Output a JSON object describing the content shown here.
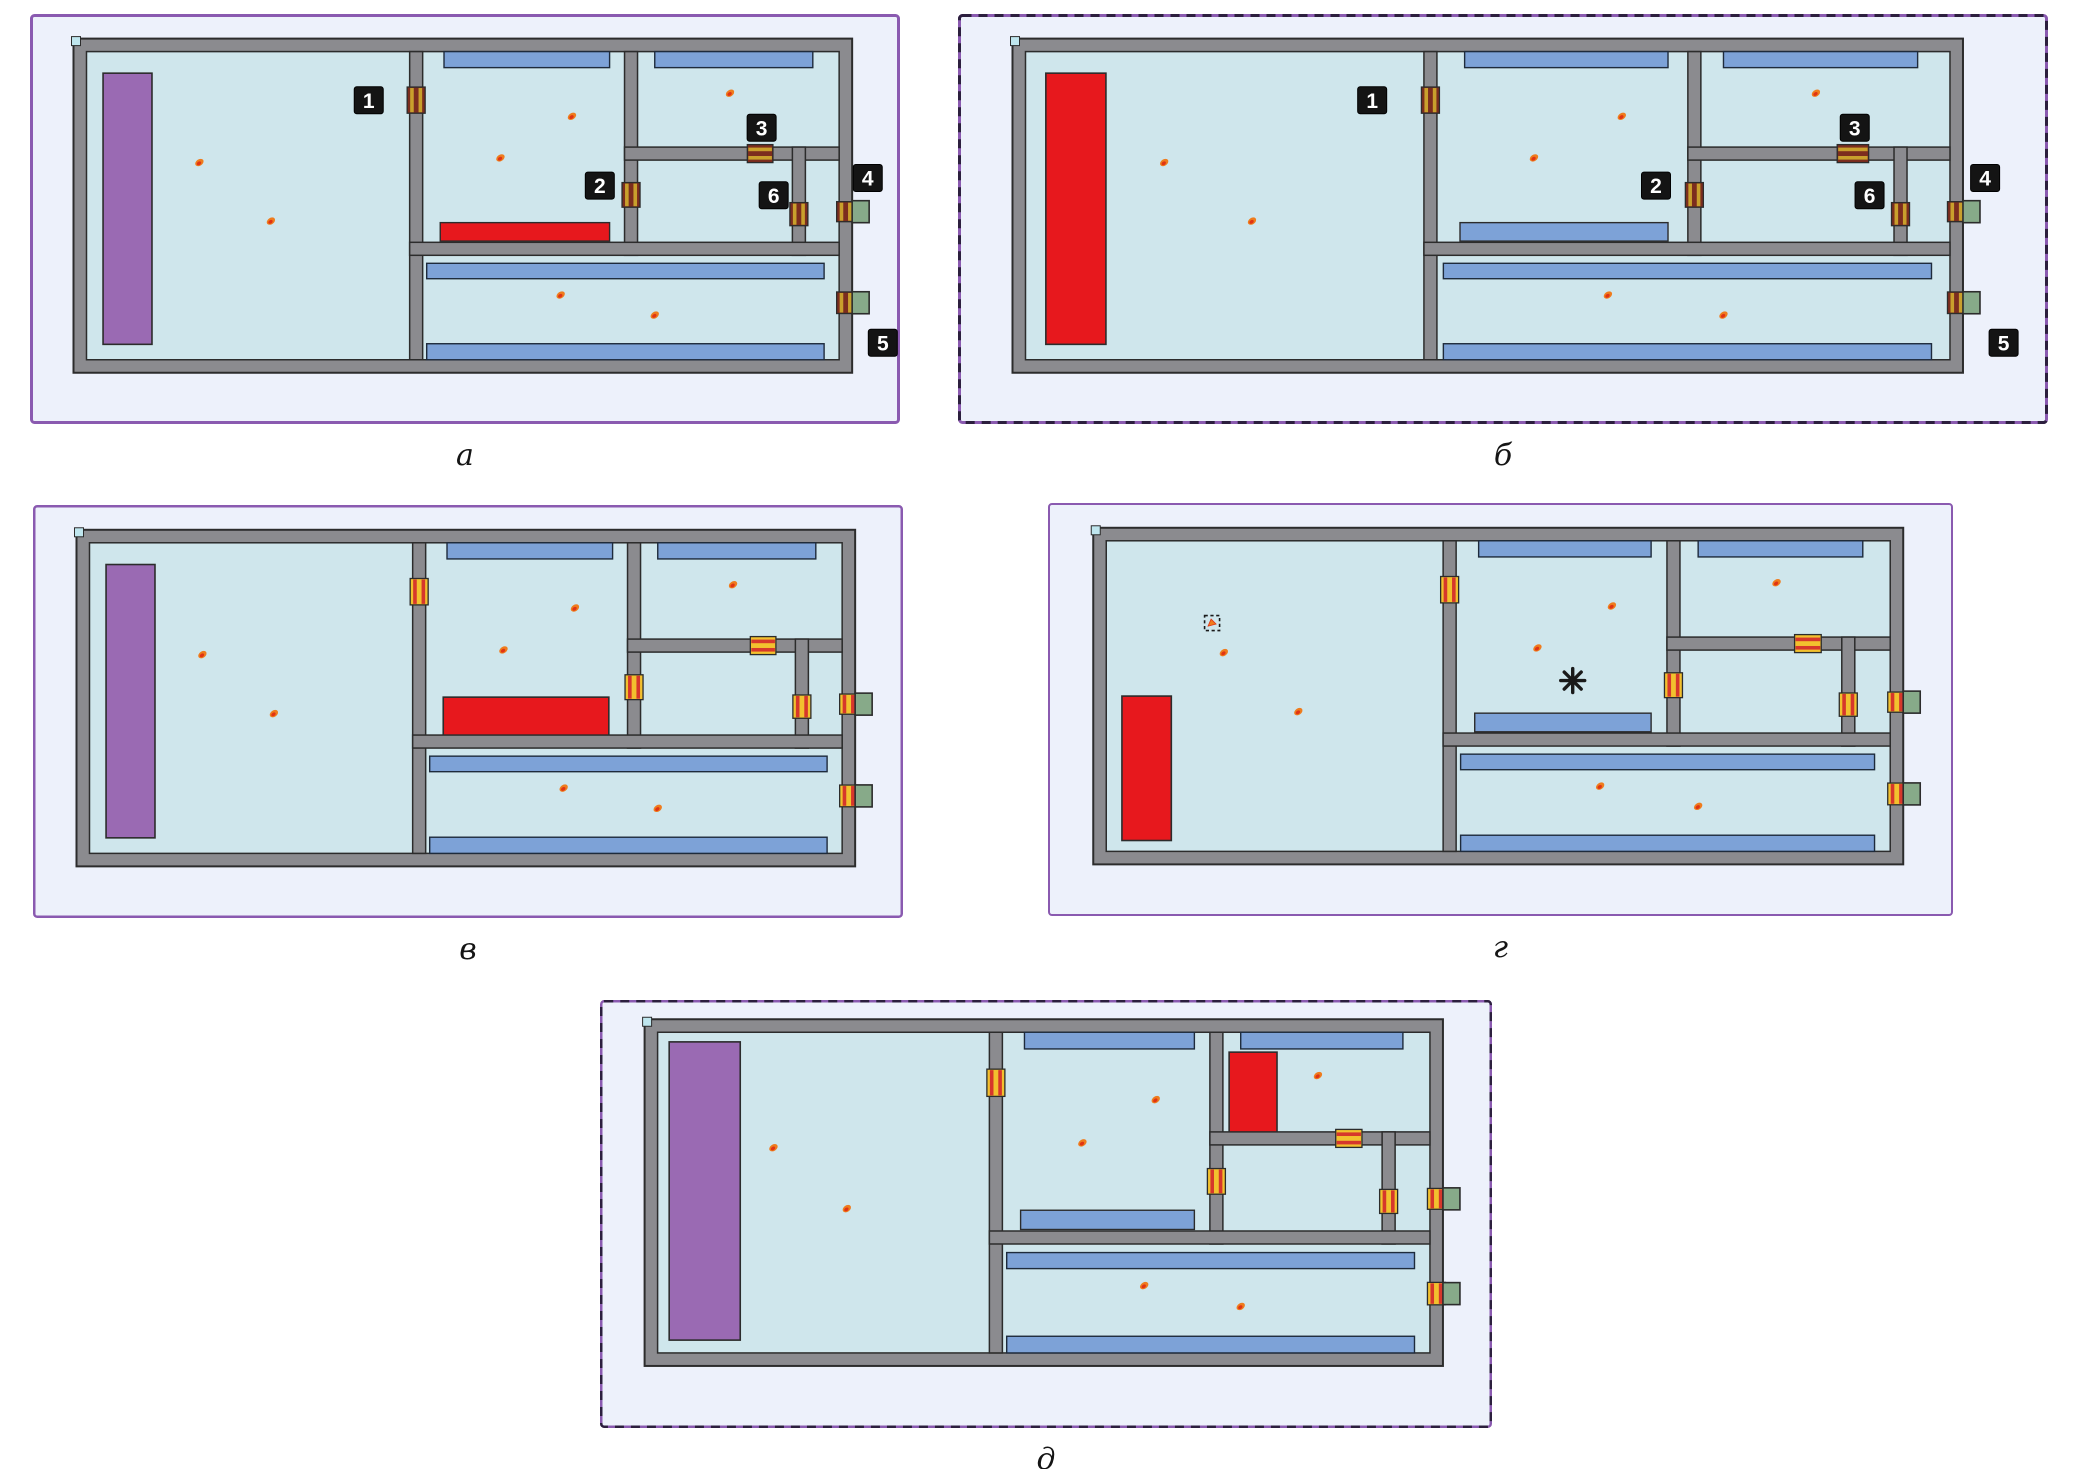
{
  "figure": {
    "colors": {
      "page_bg": "#ffffff",
      "panel_bg": "#edf1fb",
      "room": "#cfe6ec",
      "wall_fill": "#8b8b8f",
      "wall_stroke": "#2c2c2c",
      "window_blue": "#7da2d7",
      "window_stroke": "#1e2b3c",
      "stage_purple": "#9a6ab3",
      "fire_red": "#e7181d",
      "exit_green": "#87aa89",
      "door_gold_bg": "#7c2d1e",
      "door_gold_stripe": "#c9a02c",
      "door_flame_bg": "#f2c12e",
      "door_flame_stripe": "#d6372b",
      "border_purple": "#8a5ab0",
      "border_dash": "#2c1f3e",
      "callout_bg": "#141414",
      "callout_fg": "#ffffff",
      "occupant_outer": "#ef7c1d",
      "occupant_inner": "#e03414",
      "marker_dark": "#1a1a1a",
      "corner_marker": "#bfe6ee"
    },
    "plan_layout": {
      "outer": {
        "left": 0.05,
        "top": 0.06,
        "right": 0.945,
        "bottom": 0.875
      },
      "wall_px": 13,
      "walls": {
        "v1": 0.438,
        "v2": 0.7235,
        "v3": 0.9465,
        "h1": 0.331,
        "h2": 0.64
      },
      "doors": [
        {
          "id": "door-1",
          "wall": "v1",
          "from": 0.115,
          "to": 0.2
        },
        {
          "id": "door-2",
          "wall": "v2",
          "from": 0.425,
          "to": 0.505
        },
        {
          "id": "door-3",
          "wall": "h1",
          "from": 0.878,
          "to": 0.912
        },
        {
          "id": "door-6",
          "wall": "v3",
          "from": 0.49,
          "to": 0.565
        },
        {
          "id": "door-4",
          "wall": "right",
          "from": 0.487,
          "to": 0.552,
          "exit": true
        },
        {
          "id": "door-5",
          "wall": "right",
          "from": 0.78,
          "to": 0.85,
          "exit": true
        }
      ],
      "windows": [
        {
          "id": "room2-top-window",
          "x": 0.475,
          "y": 0.0,
          "w": 0.22,
          "h": 0.052
        },
        {
          "id": "room3-top-window",
          "x": 0.755,
          "y": 0.0,
          "w": 0.21,
          "h": 0.052
        },
        {
          "id": "corridor-top-window",
          "x": 0.452,
          "y": 0.687,
          "w": 0.528,
          "h": 0.05
        },
        {
          "id": "corridor-bottom-window",
          "x": 0.452,
          "y": 0.948,
          "w": 0.528,
          "h": 0.052
        }
      ],
      "room2_strip": {
        "x": 0.47,
        "y": 0.555,
        "w": 0.225,
        "h": 0.06
      },
      "stage": {
        "x": 0.022,
        "y": 0.07,
        "w": 0.065,
        "h": 0.88
      },
      "occupants": [
        {
          "x": 0.15,
          "y": 0.36
        },
        {
          "x": 0.245,
          "y": 0.55
        },
        {
          "x": 0.645,
          "y": 0.21
        },
        {
          "x": 0.55,
          "y": 0.345
        },
        {
          "x": 0.855,
          "y": 0.135
        },
        {
          "x": 0.63,
          "y": 0.79
        },
        {
          "x": 0.755,
          "y": 0.855
        }
      ],
      "callouts": [
        {
          "label": "1",
          "cx": 0.375,
          "cy": 0.158
        },
        {
          "label": "2",
          "cx": 0.682,
          "cy": 0.435
        },
        {
          "label": "3",
          "cx": 0.897,
          "cy": 0.247
        },
        {
          "label": "6",
          "cx": 0.913,
          "cy": 0.466
        },
        {
          "label": "4",
          "cx": 1.038,
          "cy": 0.41
        },
        {
          "label": "5",
          "cx": 1.058,
          "cy": 0.945
        }
      ]
    },
    "panels": [
      {
        "id": "a",
        "caption": "а",
        "x": 30,
        "y": 14,
        "w": 870,
        "h": 410,
        "border": {
          "style": "solid",
          "width": 3
        },
        "variant": {
          "stage": "purple",
          "room2_strip": "fire",
          "door_style": "gold",
          "callouts": true,
          "markers": []
        }
      },
      {
        "id": "b",
        "caption": "б",
        "x": 958,
        "y": 14,
        "w": 1090,
        "h": 410,
        "border": {
          "style": "dashed",
          "width": 3
        },
        "plan": {
          "right": 0.922
        },
        "variant": {
          "stage": "fire",
          "room2_strip": "blue",
          "door_style": "gold",
          "callouts": true,
          "markers": []
        }
      },
      {
        "id": "v",
        "caption": "в",
        "x": 33,
        "y": 505,
        "w": 870,
        "h": 413,
        "border": {
          "style": "solid",
          "width": 2.5
        },
        "variant": {
          "stage": "purple",
          "room2_strip": "none",
          "door_style": "flame",
          "callouts": false,
          "fire_rect": {
            "x": 0.47,
            "y": 0.497,
            "w": 0.22,
            "h": 0.125
          },
          "markers": []
        }
      },
      {
        "id": "g",
        "caption": "г",
        "x": 1048,
        "y": 503,
        "w": 905,
        "h": 413,
        "border": {
          "style": "solid",
          "width": 2
        },
        "variant": {
          "stage": "none",
          "room2_strip": "blue",
          "door_style": "flame",
          "callouts": false,
          "fire_rect": {
            "x": 0.02,
            "y": 0.5,
            "w": 0.063,
            "h": 0.465
          },
          "markers": [
            {
              "type": "dashed-box",
              "cx": 0.135,
              "cy": 0.265,
              "w": 15,
              "h": 15
            },
            {
              "type": "asterisk",
              "cx": 0.595,
              "cy": 0.45,
              "r": 12
            }
          ]
        }
      },
      {
        "id": "d",
        "caption": "д",
        "x": 600,
        "y": 1000,
        "w": 892,
        "h": 428,
        "border": {
          "style": "dashed",
          "width": 2.5
        },
        "plan": {
          "top": 0.045,
          "bottom": 0.855
        },
        "variant": {
          "stage": "purple",
          "stage_rect": {
            "x": 0.015,
            "y": 0.03,
            "w": 0.092,
            "h": 0.93
          },
          "room2_strip": "blue",
          "door_style": "flame",
          "callouts": false,
          "fire_rect": {
            "x": 0.74,
            "y": 0.062,
            "w": 0.062,
            "h": 0.25
          },
          "markers": []
        }
      }
    ]
  }
}
